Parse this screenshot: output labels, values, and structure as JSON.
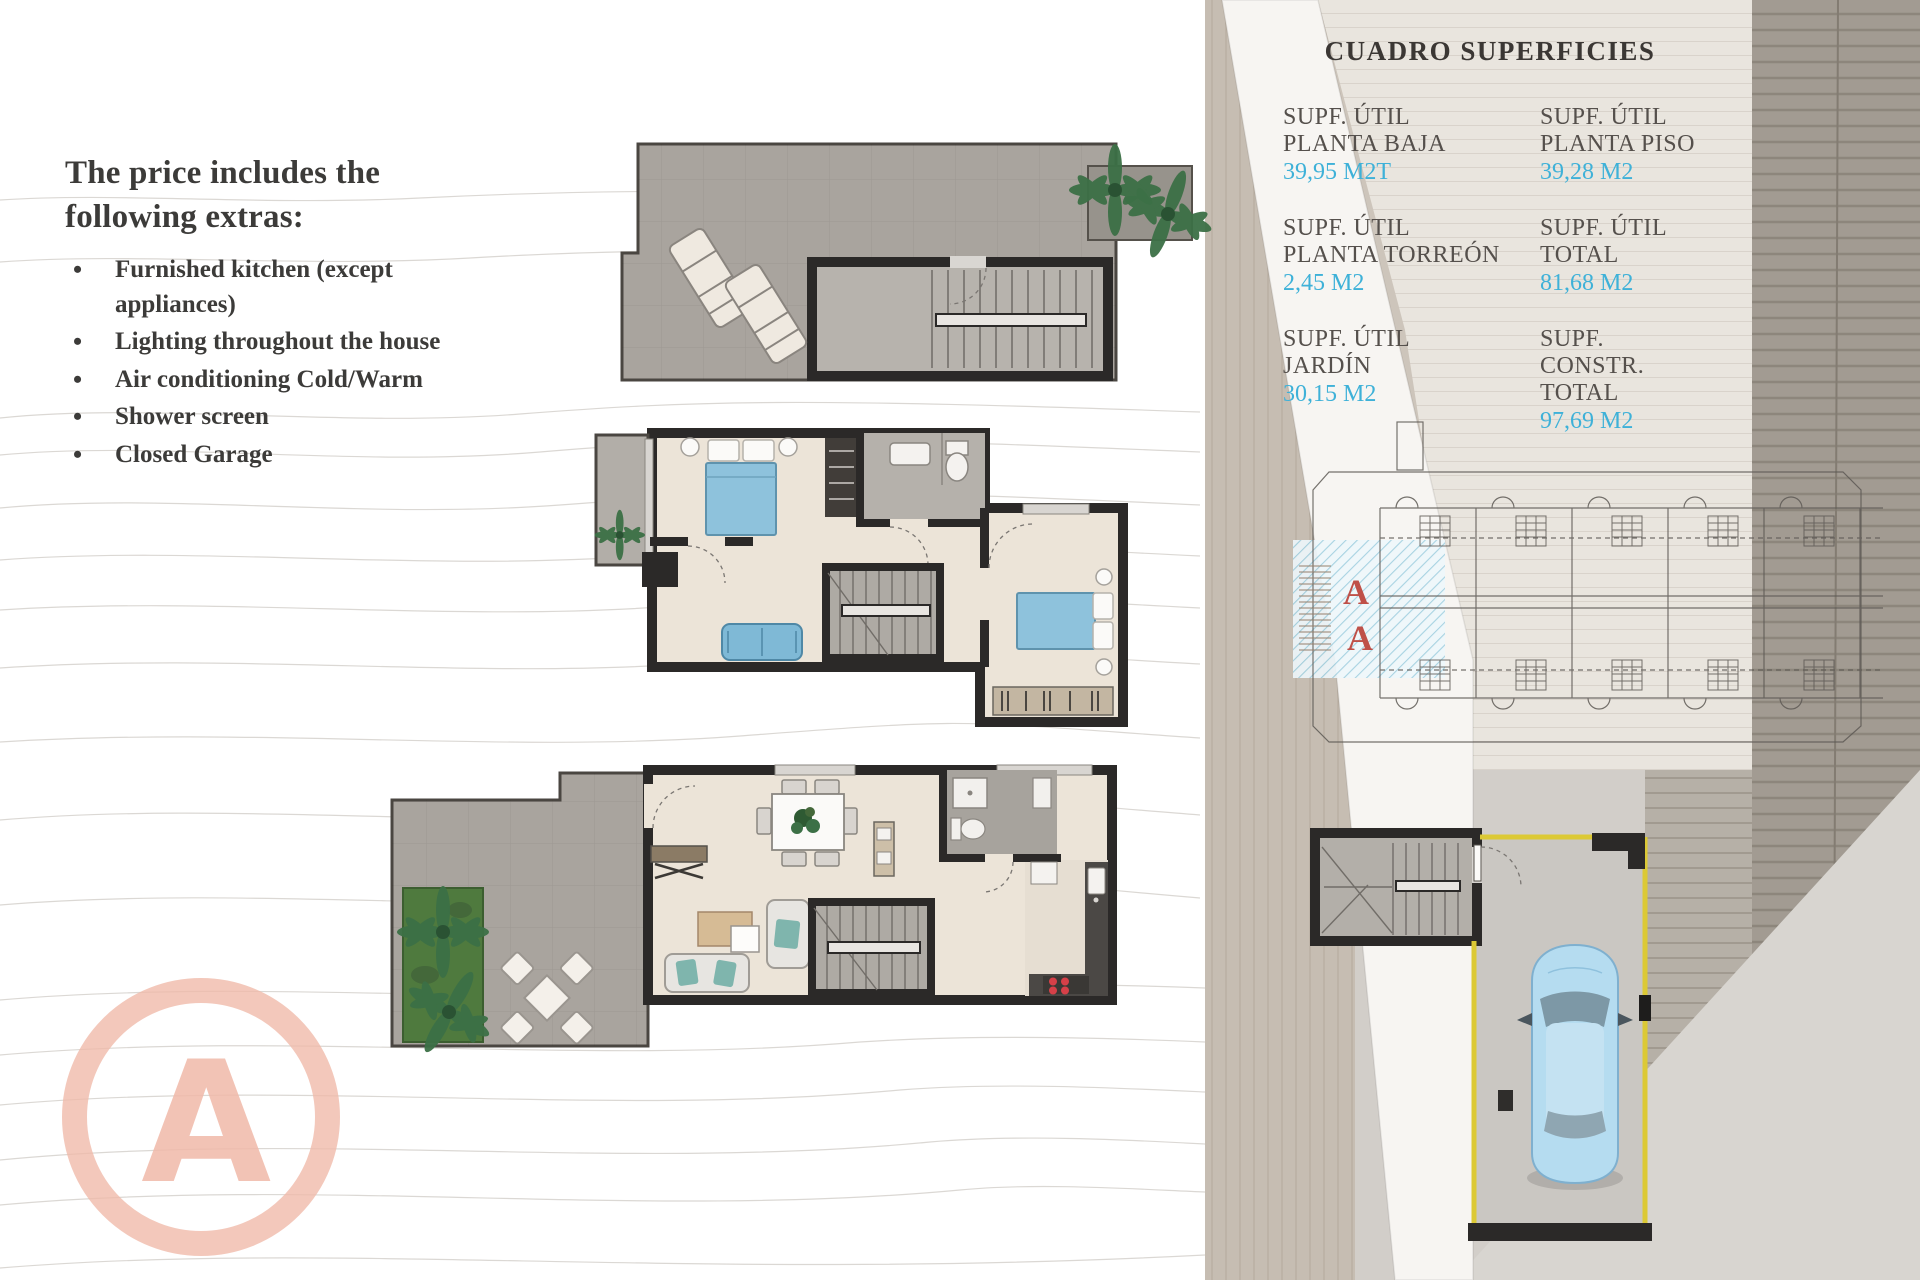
{
  "extras": {
    "heading": "The price includes the\nfollowing extras:",
    "bullet": "•",
    "items": [
      "Furnished kitchen (except appliances)",
      "Lighting throughout the house",
      "Air conditioning Cold/Warm",
      "Shower screen",
      "Closed Garage"
    ]
  },
  "superficies": {
    "title": "CUADRO SUPERFICIES",
    "entries": [
      {
        "label": "SUPF. ÚTIL\nPLANTA BAJA",
        "value": "39,95 M2T"
      },
      {
        "label": "SUPF. ÚTIL\nPLANTA PISO",
        "value": "39,28 M2"
      },
      {
        "label": "SUPF. ÚTIL\nPLANTA TORREÓN",
        "value": "2,45 M2"
      },
      {
        "label": "SUPF. ÚTIL\nTOTAL",
        "value": "81,68 M2"
      },
      {
        "label": "SUPF. ÚTIL\nJARDÍN",
        "value": "30,15 M2"
      },
      {
        "label": "SUPF. CONSTR.\nTOTAL",
        "value": "97,69 M2"
      }
    ]
  },
  "site_plan": {
    "unit_label": "A"
  },
  "logo": {
    "letter": "A"
  },
  "colors": {
    "value_cyan": "#3eb1d8",
    "unit_label_red": "#bf5048",
    "logo_salmon": "#f0b9a8",
    "plan_wall": "#2b2928",
    "furniture_blue": "#8ec2dc",
    "garage_line_yellow": "#dcc935",
    "car_blue": "#b5dcf0",
    "lawn_green": "#4f7a3e"
  }
}
